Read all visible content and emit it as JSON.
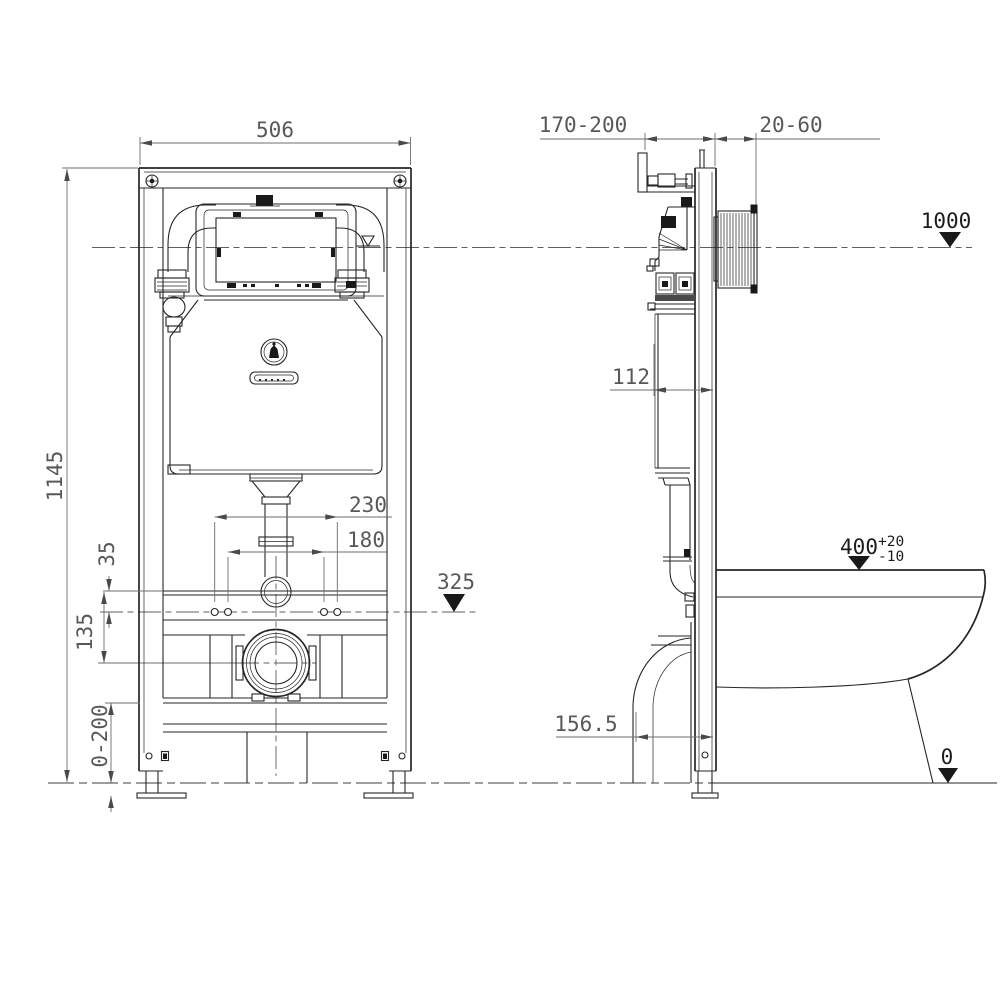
{
  "colors": {
    "background": "#ffffff",
    "drawing_line": "#262626",
    "dimension_line": "#6d6d6d",
    "dimension_text": "#585858",
    "level_text": "#1c1c1c"
  },
  "front_view": {
    "dim_width": "506",
    "dim_height": "1145",
    "dim_fixing_outer": "230",
    "dim_fixing_inner": "180",
    "dim_rail_offset": "35",
    "dim_drain_offset": "135",
    "dim_foot_range": "0-200",
    "level_flush_axis": "325"
  },
  "side_view": {
    "dim_bracket_range": "170-200",
    "dim_wall_finish": "20-60",
    "level_top": "1000",
    "dim_frame_depth": "112",
    "dim_drain_setback": "156.5",
    "dim_bowl_height": "400",
    "dim_bowl_tol_plus": "+20",
    "dim_bowl_tol_minus": "-10",
    "level_floor": "0"
  }
}
